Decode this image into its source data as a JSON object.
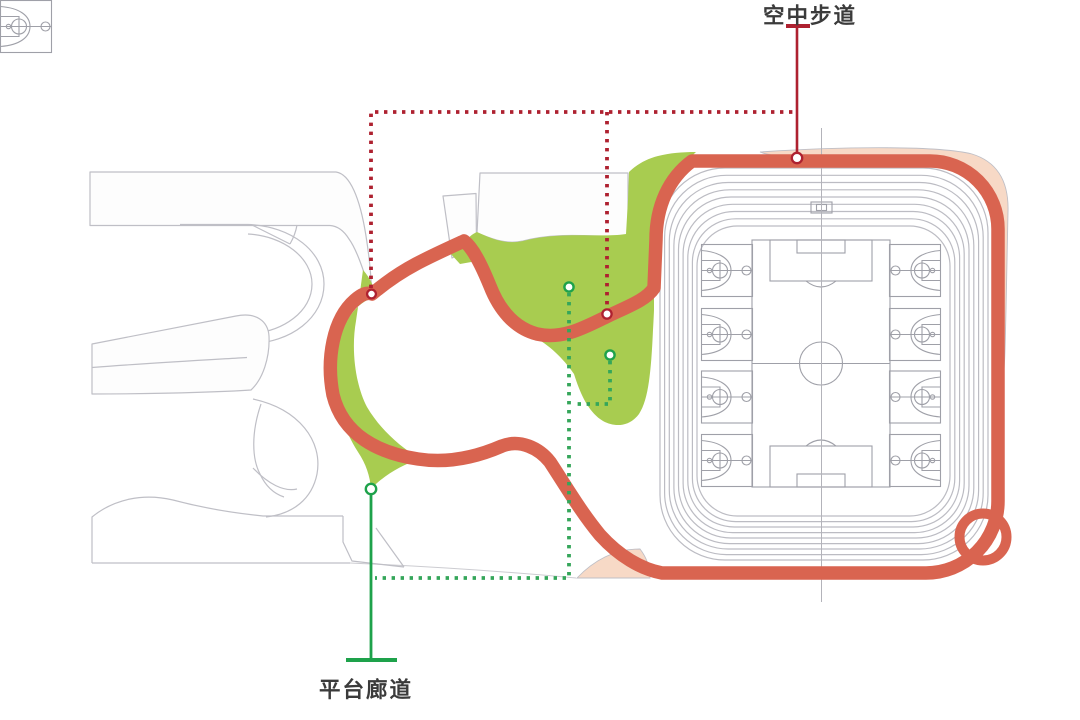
{
  "diagram": {
    "annotations": [
      {
        "id": "aerial-walkway",
        "label": "空中步道"
      },
      {
        "id": "platform-corridor",
        "label": "平台廊道"
      }
    ]
  },
  "colors": {
    "walkway": "#d96450",
    "walkway-leader": "#ae2130",
    "corridor-leader": "#1ea24b",
    "corridor-dot": "#35a65a",
    "green-area": "#a8cc50",
    "peach-area": "#f7d9c6",
    "outline": "#bfbfc6",
    "lane": "#bcbcc3",
    "field-line": "#9fa0a8",
    "label-text": "#3b3b3b",
    "node-fill": "#ffffff"
  }
}
